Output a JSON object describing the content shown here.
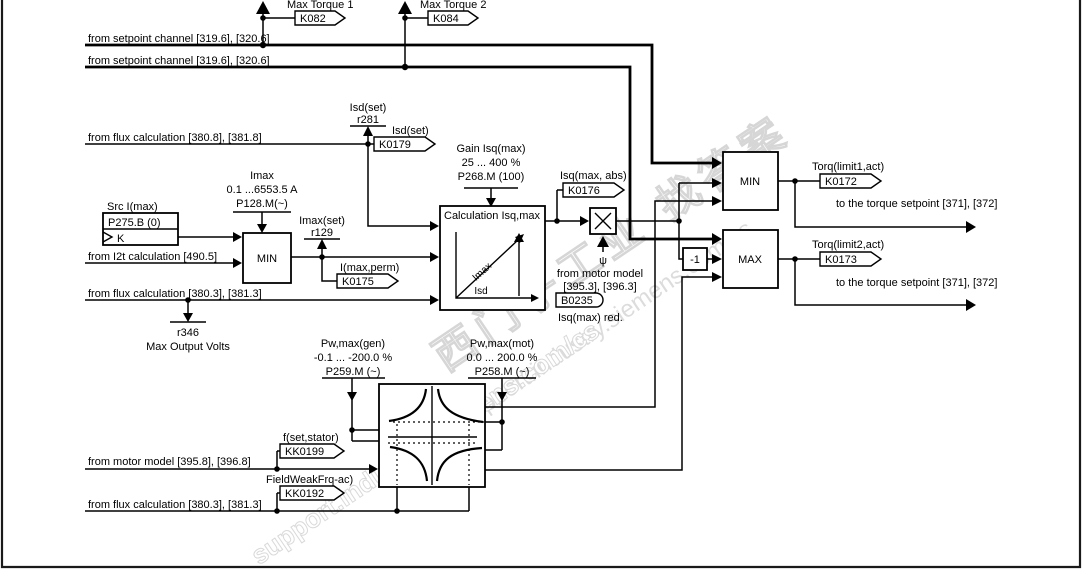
{
  "watermark": {
    "cn": "西门子工业 找答案",
    "url": "support.industry.siemens.com/cs"
  },
  "outputs_top": {
    "t1": {
      "label": "Max Torque 1",
      "id": "K082"
    },
    "t2": {
      "label": "Max Torque 2",
      "id": "K084"
    }
  },
  "left_inputs": {
    "setpoint1": "from setpoint channel [319.6], [320.6]",
    "setpoint2": "from setpoint channel [319.6], [320.6]",
    "flux_hi": "from flux calculation [380.8], [381.8]",
    "i2t": "from I2t calculation [490.5]",
    "flux_lo1": "from flux calculation [380.3], [381.3]",
    "motor_model": "from motor model [395.8], [396.8]",
    "flux_lo2": "from flux calculation [380.3], [381.3]"
  },
  "displays": {
    "isd_set": {
      "signal": "Isd(set)",
      "id": "r281"
    },
    "imax_set": {
      "signal": "Imax(set)",
      "id": "r129"
    },
    "max_output_volts": {
      "id": "r346",
      "label": "Max Output Volts"
    }
  },
  "connectors": {
    "k0179": {
      "label": "Isd(set)",
      "id": "K0179"
    },
    "k0175": {
      "label": "I(max,perm)",
      "id": "K0175"
    },
    "k0176": {
      "label": "Isq(max, abs)",
      "id": "K0176"
    },
    "k0172": {
      "label": "Torq(limit1,act)",
      "id": "K0172",
      "dest": "to the torque setpoint [371], [372]"
    },
    "k0173": {
      "label": "Torq(limit2,act)",
      "id": "K0173",
      "dest": "to the torque setpoint [371], [372]"
    },
    "kk0199": {
      "label": "f(set,stator)",
      "id": "KK0199"
    },
    "kk0192": {
      "label": "FieldWeakFrq-ac)",
      "id": "KK0192"
    },
    "b0235": {
      "psi": "ψ",
      "src1": "from motor model",
      "src2": "[395.3], [396.3]",
      "id": "B0235",
      "note": "Isq(max) red."
    }
  },
  "params": {
    "src_imax": {
      "label": "Src I(max)",
      "id": "P275.B (0)",
      "k": "K"
    },
    "imax": {
      "name": "Imax",
      "range": "0.1 ...6553.5 A",
      "id": "P128.M(~)"
    },
    "gain_isq": {
      "name": "Gain Isq(max)",
      "range": "25 ... 400 %",
      "id": "P268.M (100)"
    },
    "pw_gen": {
      "name": "Pw,max(gen)",
      "range": "-0.1 ... -200.0 %",
      "id": "P259.M (~)"
    },
    "pw_mot": {
      "name": "Pw,max(mot)",
      "range": "0.0 ... 200.0 %",
      "id": "P258.M (~)"
    }
  },
  "blocks": {
    "min1": "MIN",
    "min2": "MIN",
    "max": "MAX",
    "inv": "-1",
    "calc": {
      "title": "Calculation Isq,max",
      "imax": "Imax",
      "isd": "Isd"
    }
  }
}
